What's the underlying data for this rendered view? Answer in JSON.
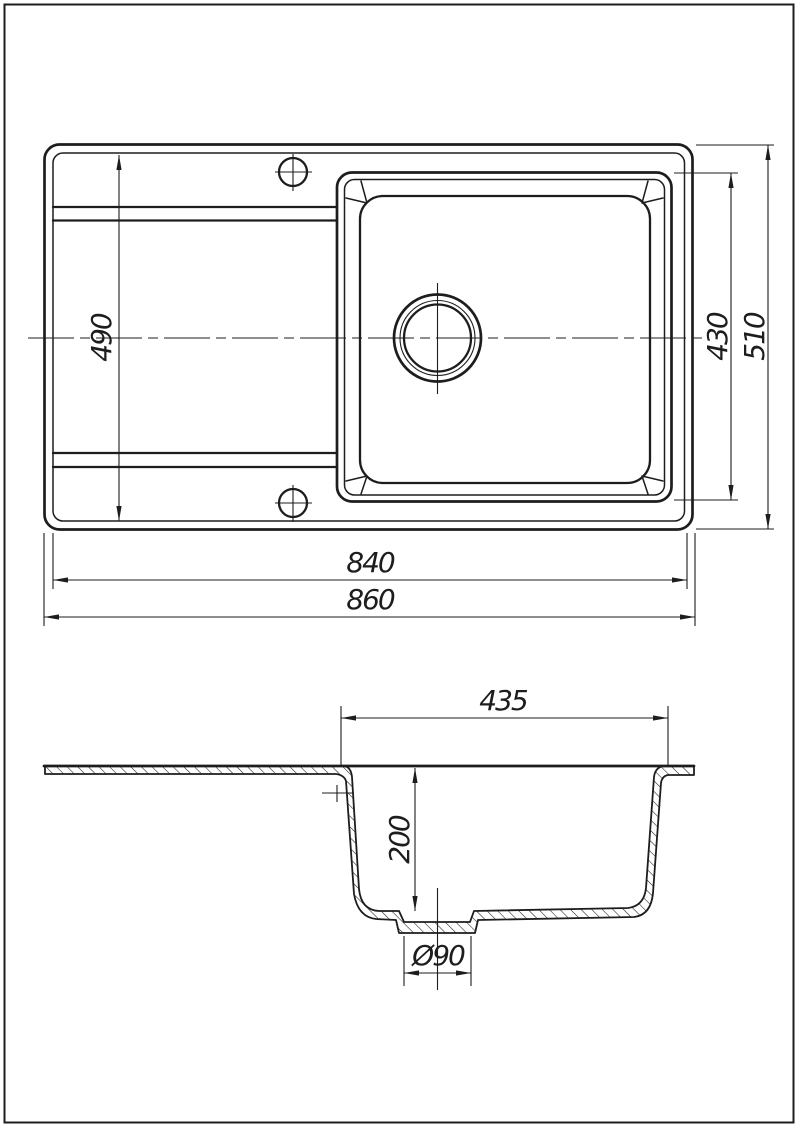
{
  "drawing": {
    "type": "technical-drawing",
    "subject": "kitchen sink with drainboard - top view and sectional side view",
    "colors": {
      "background": "#ffffff",
      "line": "#1d1d1d"
    }
  },
  "dimensions": {
    "drainboard_width": "490",
    "bowl_length": "430",
    "overall_depth": "510",
    "inner_length": "840",
    "overall_length": "860",
    "bowl_top_width": "435",
    "bowl_depth": "200",
    "drain_diameter": "Ø90"
  }
}
